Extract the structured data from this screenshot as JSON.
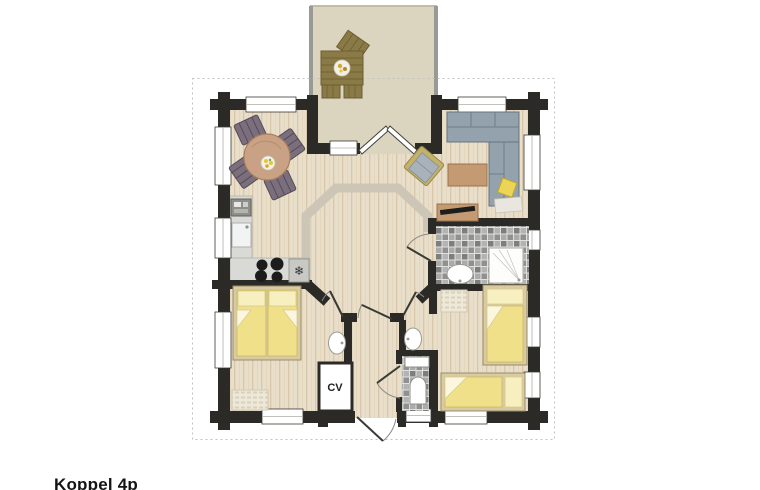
{
  "plan": {
    "caption": "Koppel 4p",
    "cv_label": "CV",
    "icons": {
      "fridge_snowflake": "❄"
    },
    "colors": {
      "wall": "#2b2a26",
      "wood_floor": "#e9dec9",
      "terrace": "#dbd5c0",
      "octagon_band": "#cdc5b6",
      "bed_yellow": "#efe089",
      "pillow_yellow": "#f7efc0",
      "sofa_gray": "#93a2ad",
      "chair_mauve": "#7b6f7d",
      "tile_gray": "#9a9a9a",
      "furniture_wood": "#c49a72",
      "terrace_wood": "#8a7a46",
      "counter_gray": "#d9d9d5",
      "boundary_dash": "#c2c2c2"
    }
  }
}
